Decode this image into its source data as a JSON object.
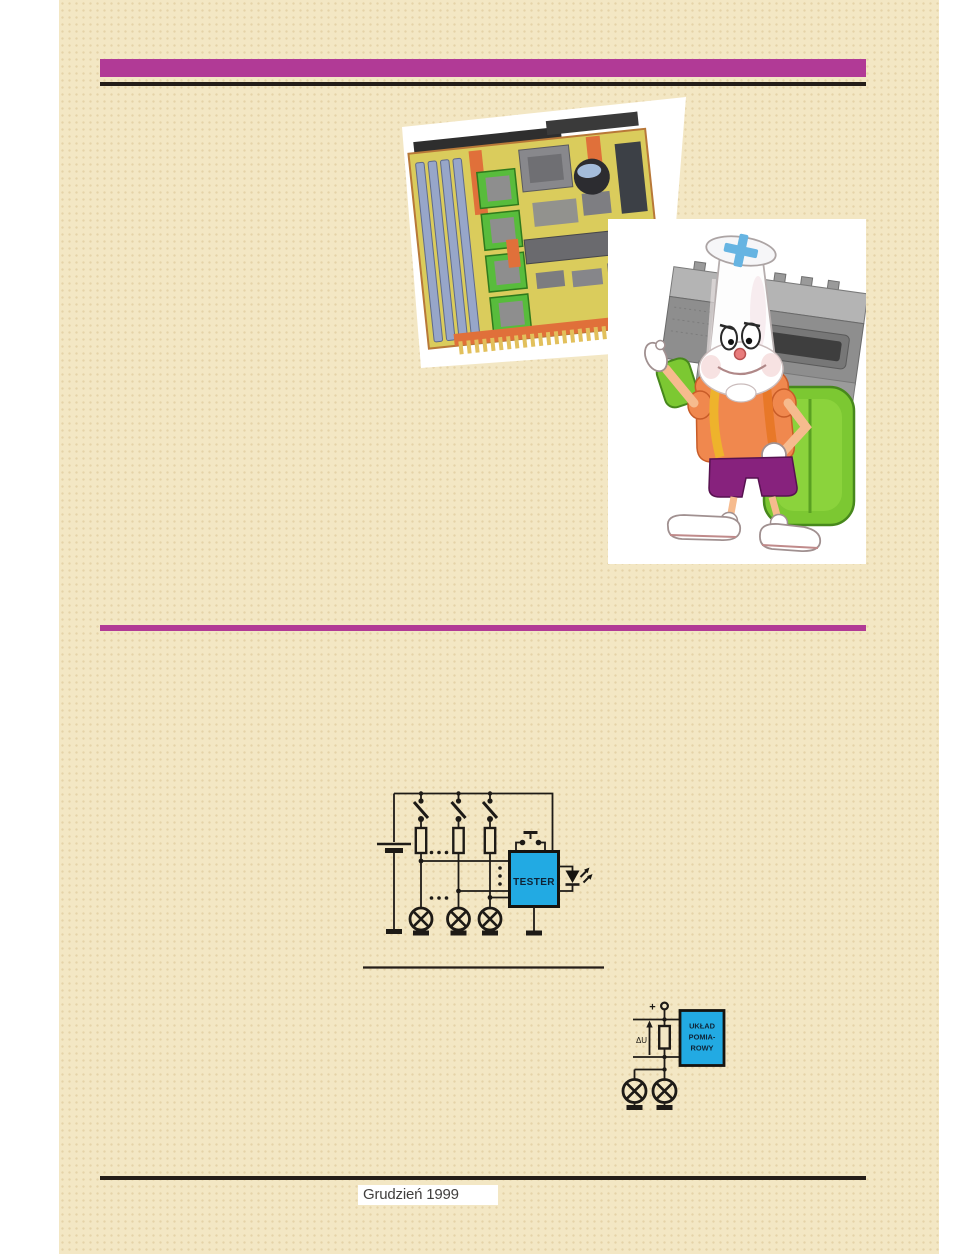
{
  "page": {
    "issue_date": "Grudzień 1999",
    "colors": {
      "paper": "#f3e7c4",
      "margin_white": "#ffffff",
      "accent_magenta": "#b13a96",
      "rule_dark": "#241d18",
      "schematic_line": "#1d1a16",
      "schematic_box_blue": "#22aae3"
    }
  },
  "tester_schematic": {
    "box_label": "TESTER"
  },
  "measurement_schematic": {
    "plus_label": "+",
    "voltage_label": "ΔU",
    "box_label_lines": [
      "UKŁAD",
      "POMIA-",
      "ROWY"
    ]
  }
}
